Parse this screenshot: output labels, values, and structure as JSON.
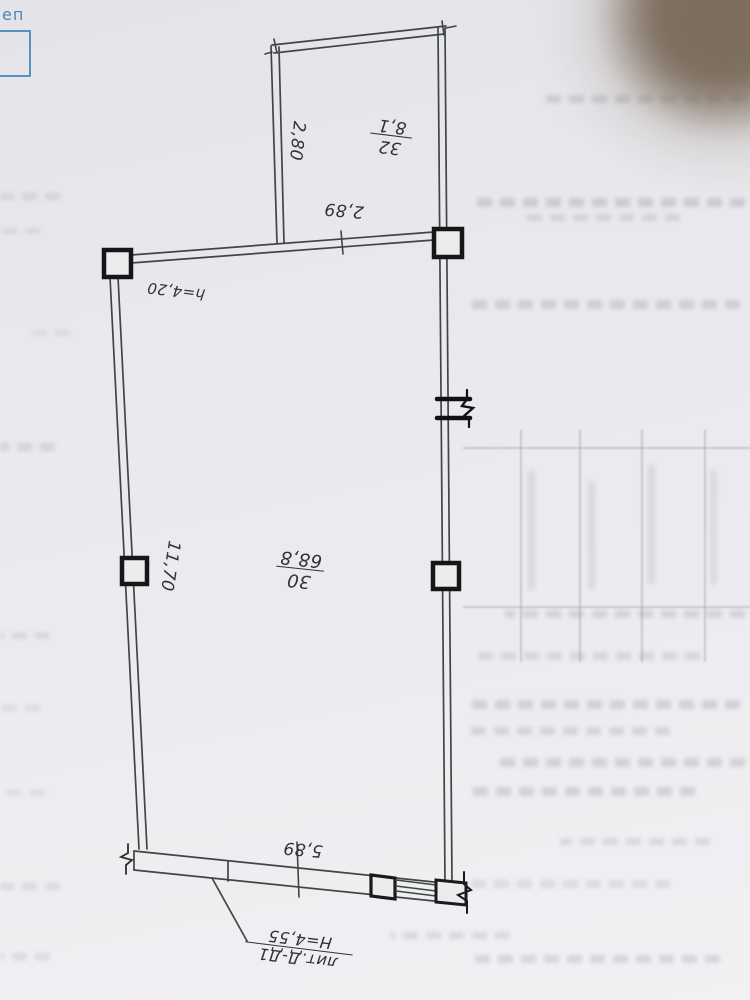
{
  "stamp": {
    "partial_text": "еп"
  },
  "plan": {
    "rooms": [
      {
        "number": "32",
        "area": "8,1",
        "dim_a": "2,80",
        "dim_b": "2,89"
      },
      {
        "number": "30",
        "area": "68,8",
        "dim_a": "11,70",
        "dim_b": "5,89",
        "ceiling_height": "h=4,20"
      }
    ],
    "callout": {
      "litera": "лит.Д-Д1",
      "building_height": "Н=4,55"
    }
  }
}
